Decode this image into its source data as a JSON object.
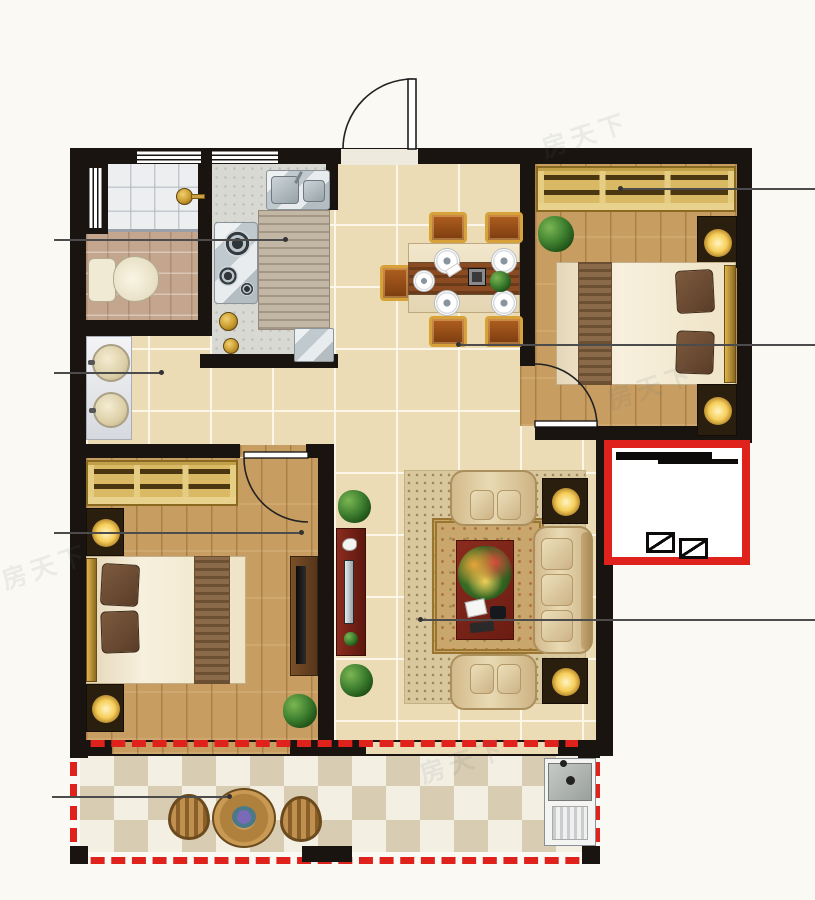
{
  "meta": {
    "title": "Residential floor plan",
    "type": "Two-bedroom apartment, top-down rendered floor plan with callout leader lines"
  },
  "palette": {
    "wall_black": "#1a1410",
    "accent_red": "#e0221c",
    "floor_tile_beige": "#ecdcb6",
    "wood_floor": "#c79d61",
    "kitchen_floor_gray": "#d9d9d4",
    "bath_tile_brown": "#c4a68e",
    "shower_marble": "#eceef0",
    "balcony_tile_tan": "#d8ccb2",
    "balcony_tile_white": "#f4efe3",
    "wardrobe_gold": "#d9b964",
    "furniture_maroon": "#7c241a",
    "lamp_glow": "#f2c24e"
  },
  "watermark": {
    "text": "房天下"
  },
  "rooms": {
    "bathroom": {
      "label": "Bathroom with shower area and toilet"
    },
    "kitchen": {
      "label": "Kitchen with double sink, gas stove, counter and fridge"
    },
    "hallway": {
      "label": "Hallway with double-basin vanity"
    },
    "dining": {
      "label": "Dining area with six-seat table"
    },
    "bedroom_top": {
      "label": "Bedroom (top right) with wardrobe and double bed"
    },
    "bedroom_bottom": {
      "label": "Bedroom (bottom left) with wardrobe, double bed and TV cabinet"
    },
    "living": {
      "label": "Living room with sofa set, coffee table, rug and TV stand"
    },
    "balcony": {
      "label": "Open balcony (red dashed) with bistro set and laundry unit"
    },
    "platform": {
      "label": "Equipment platform (red outline) with sliding window"
    }
  },
  "labels": {
    "entry_door": "Entry door swing",
    "bedroom_door": "Bedroom door swing",
    "window": "Window",
    "leader_line": "Callout leader line",
    "toilet": "Toilet",
    "shower": "Shower area with floor drain",
    "vanity": "Double-basin vanity",
    "kitchen_sink": "Double-bowl kitchen sink",
    "stove": "Gas stove",
    "counter": "Kitchen countertop",
    "fridge": "Refrigerator",
    "jar": "Kitchen jar",
    "dining_table": "Dining table",
    "dining_chair": "Dining chair",
    "plate": "Place setting",
    "centerpiece": "Table centerpiece",
    "wardrobe": "Wardrobe with hangers",
    "bed": "Double bed",
    "pillow": "Pillow",
    "nightstand": "Nightstand with lamp",
    "tv_cabinet": "TV cabinet with TV",
    "tv_stand": "Living room TV stand",
    "plant": "Potted plant",
    "rug": "Area rug",
    "sofa": "Three-seat sofa",
    "armchair": "Two-seat armchair",
    "side_table": "Side table with lamp",
    "coffee_table": "Coffee table with flower arrangement",
    "balcony_table": "Round bistro table",
    "balcony_chair": "Bistro chair",
    "laundry": "Laundry sink and washing machine",
    "ac_symbol": "Equipment symbols",
    "sliding_window": "Sliding window symbol"
  }
}
